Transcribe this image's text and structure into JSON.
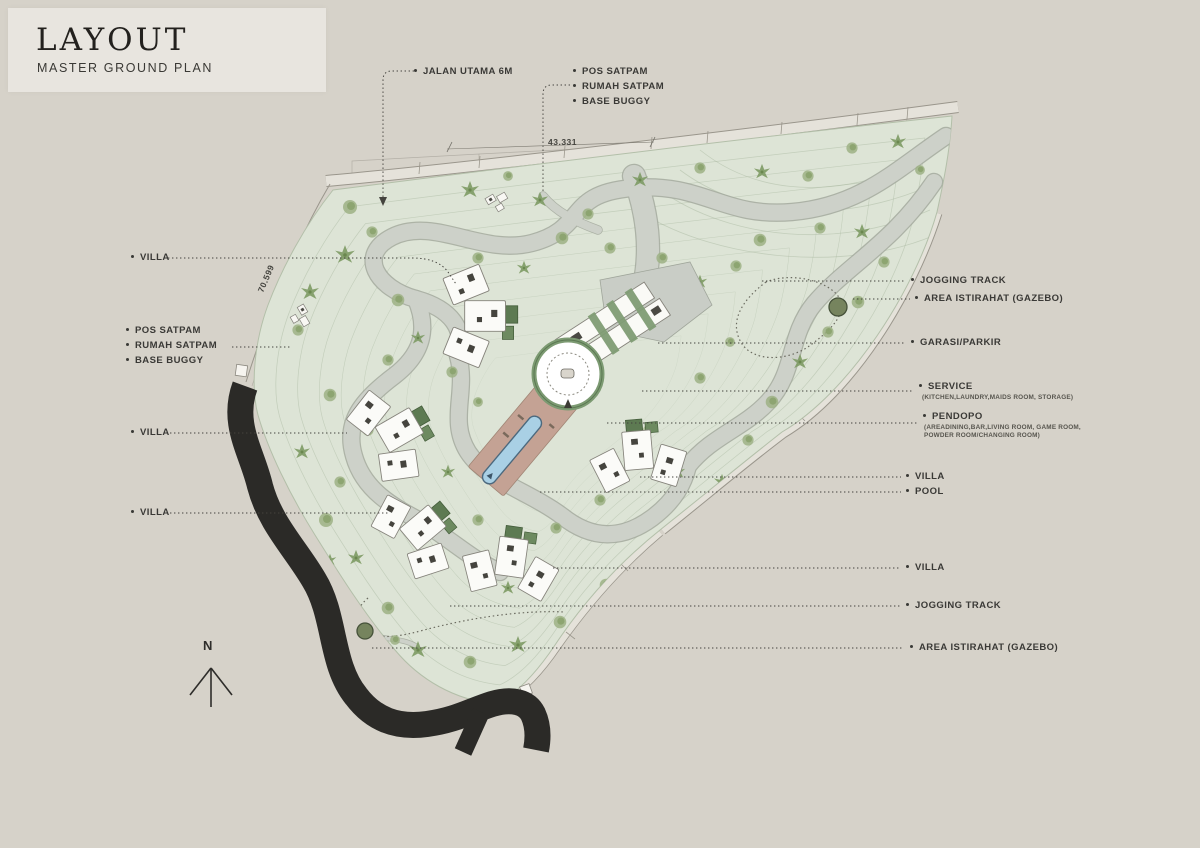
{
  "title": {
    "heading": "LAYOUT",
    "subheading": "MASTER GROUND PLAN"
  },
  "dimensions": {
    "top": "43.331",
    "side": "70.599"
  },
  "compass": {
    "label": "N"
  },
  "labels": {
    "top": [
      {
        "text": "JALAN UTAMA 6M"
      },
      {
        "text": "POS SATPAM"
      },
      {
        "text": "RUMAH SATPAM"
      },
      {
        "text": "BASE BUGGY"
      }
    ],
    "left": [
      {
        "text": "VILLA"
      },
      {
        "text": "POS SATPAM"
      },
      {
        "text": "RUMAH SATPAM"
      },
      {
        "text": "BASE BUGGY"
      },
      {
        "text": "VILLA"
      },
      {
        "text": "VILLA"
      }
    ],
    "right": [
      {
        "text": "JOGGING TRACK"
      },
      {
        "text": "AREA ISTIRAHAT (GAZEBO)"
      },
      {
        "text": "GARASI/PARKIR"
      },
      {
        "text": "SERVICE",
        "sub": "(KITCHEN,LAUNDRY,MAIDS ROOM, STORAGE)"
      },
      {
        "text": "PENDOPO",
        "sub": "(AREADINING,BAR,LIVING ROOM, GAME ROOM, POWDER ROOM/CHANGING ROOM)"
      },
      {
        "text": "VILLA"
      },
      {
        "text": "POOL"
      },
      {
        "text": "VILLA"
      },
      {
        "text": "JOGGING TRACK"
      },
      {
        "text": "AREA ISTIRAHAT (GAZEBO)"
      }
    ]
  },
  "colors": {
    "background": "#d6d2c9",
    "card": "#e8e5df",
    "terrain": "#dde4d6",
    "road": "#cdd1c9",
    "asphalt_road": "#2b2a27",
    "pool": "#a9d0e5",
    "terrace": "#c4a294",
    "accent_green": "#7c9a72",
    "label_text": "#3a3936"
  }
}
